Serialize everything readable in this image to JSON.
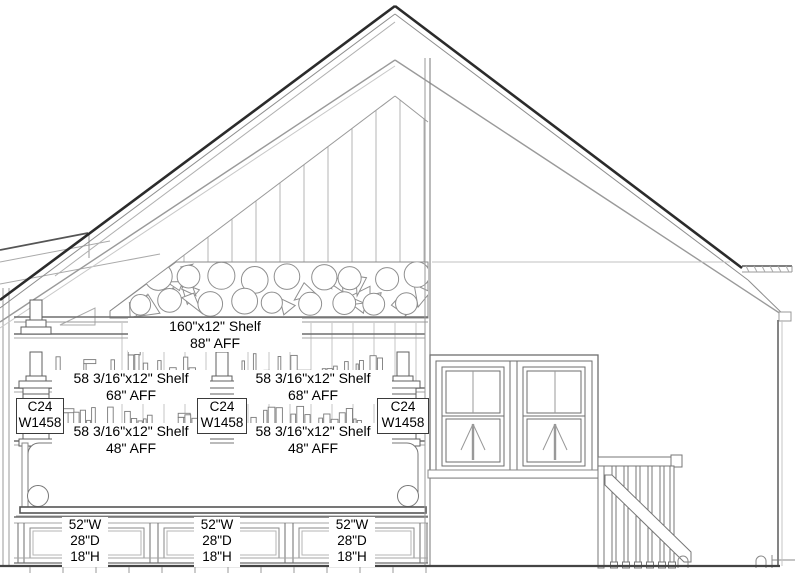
{
  "drawing": {
    "title": "interior-elevation-section",
    "line_color_dark": "#2b2b2b",
    "line_color_mid": "#6e6e6e",
    "line_color_light": "#b5b5b5",
    "background": "#ffffff"
  },
  "annotations": {
    "shelf_labels": [
      {
        "size": "160\"x12\" Shelf",
        "height": "88\" AFF"
      },
      {
        "size": "58 3/16\"x12\" Shelf",
        "height": "68\" AFF"
      },
      {
        "size": "58 3/16\"x12\" Shelf",
        "height": "68\" AFF"
      },
      {
        "size": "58 3/16\"x12\" Shelf",
        "height": "48\" AFF"
      },
      {
        "size": "58 3/16\"x12\" Shelf",
        "height": "48\" AFF"
      }
    ],
    "column_tags": [
      {
        "code": "C24",
        "model": "W1458"
      },
      {
        "code": "C24",
        "model": "W1458"
      },
      {
        "code": "C24",
        "model": "W1458"
      }
    ],
    "cabinet_tags": [
      {
        "width": "52\"W",
        "depth": "28\"D",
        "height": "18\"H"
      },
      {
        "width": "52\"W",
        "depth": "28\"D",
        "height": "18\"H"
      },
      {
        "width": "52\"W",
        "depth": "28\"D",
        "height": "18\"H"
      }
    ]
  }
}
